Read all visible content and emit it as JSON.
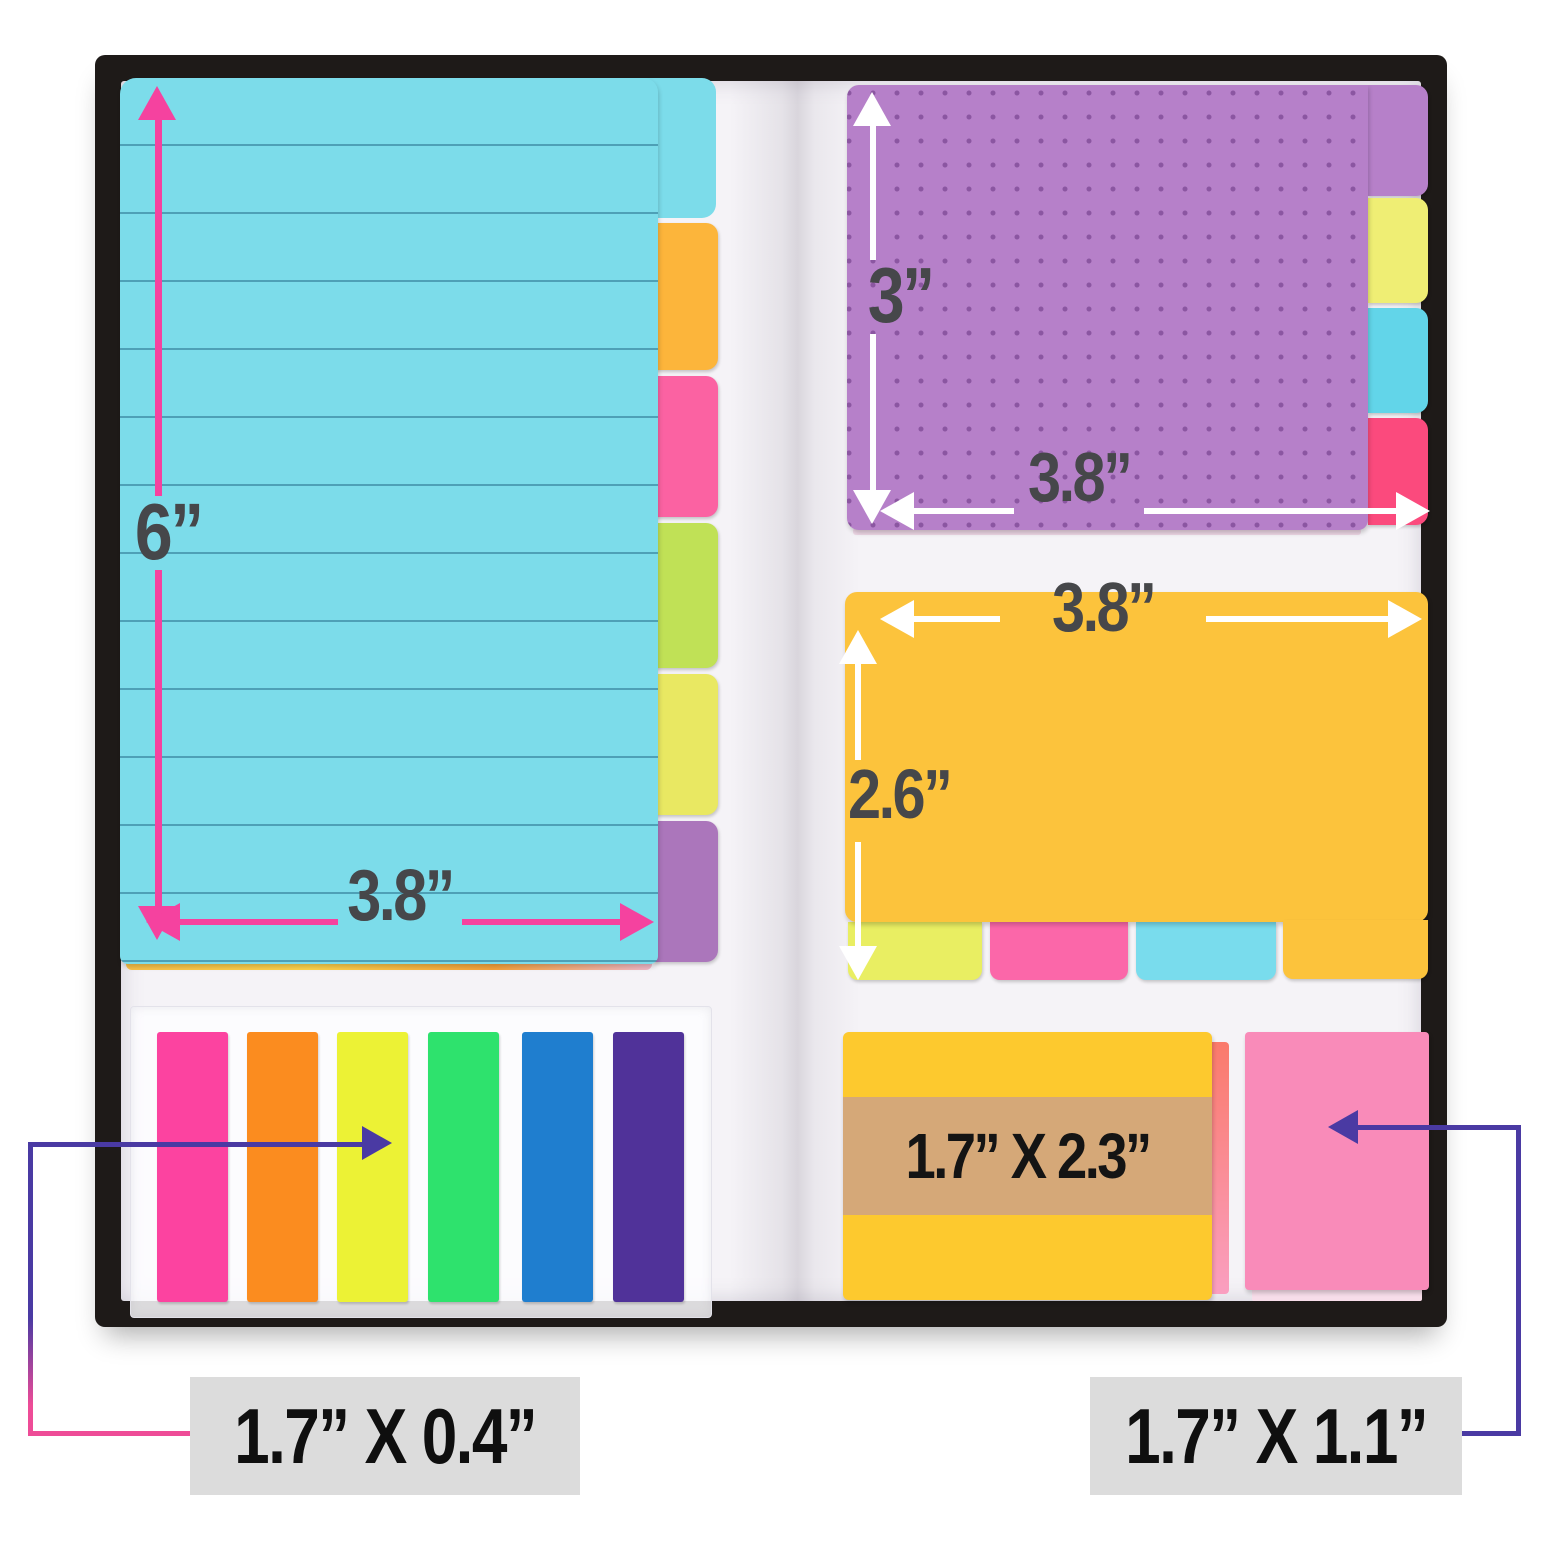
{
  "title": "Divider sticky notes set in black book cover with size annotations",
  "canvas": {
    "background": "#ffffff",
    "cover_color": "#1e1a18",
    "page_color": "#f5f3f7"
  },
  "dimension_text_color": "#46474a",
  "left_pad": {
    "description": "lined divider sticky note pad",
    "bg": "#7cdcea",
    "line_color": "#20647f",
    "height_label": "6”",
    "width_label": "3.8”",
    "arrow_color": "#f5429f",
    "tabs": [
      {
        "name": "cyan",
        "color": "#7cdcea"
      },
      {
        "name": "orange",
        "color": "#fcb53b"
      },
      {
        "name": "pink",
        "color": "#fb62a2"
      },
      {
        "name": "green",
        "color": "#c0e156"
      },
      {
        "name": "yellow",
        "color": "#e9e862"
      },
      {
        "name": "purple",
        "color": "#ab76bb"
      }
    ]
  },
  "purple_note": {
    "description": "dot-grid divider sticky note",
    "bg": "#b680c9",
    "dot_color": "#683480",
    "height_label": "3”",
    "width_label": "3.8”",
    "arrow_color": "#ffffff",
    "tabs": [
      {
        "name": "purple",
        "color": "#b680c9"
      },
      {
        "name": "yellow",
        "color": "#efee74"
      },
      {
        "name": "blue",
        "color": "#62d5e9"
      },
      {
        "name": "pink",
        "color": "#fb4a7d"
      }
    ]
  },
  "orange_note": {
    "description": "blank divider sticky note",
    "bg": "#fcc33c",
    "width_label": "3.8”",
    "height_label": "2.6”",
    "arrow_color": "#ffffff",
    "tabs": [
      {
        "name": "yellow-green",
        "color": "#e9ee62"
      },
      {
        "name": "pink",
        "color": "#fb67a9"
      },
      {
        "name": "blue",
        "color": "#79dced"
      },
      {
        "name": "orange",
        "color": "#fcc33c"
      }
    ]
  },
  "small_yellow_note": {
    "bg": "#fdc92e",
    "band_color": "#d5a878",
    "size_label": "1.7” X 2.3”"
  },
  "small_pink_note": {
    "bg": "#f98bb9",
    "size_label": "1.7” X 1.1”"
  },
  "page_flags": {
    "description": "six neon page marker flags on clear sheet",
    "size_label": "1.7” X 0.4”",
    "colors": [
      "#fc43a0",
      "#fb8c1f",
      "#ecf235",
      "#2ee26d",
      "#1f7ecf",
      "#503299"
    ]
  },
  "callouts": {
    "line_indigo": "#4a3aa3",
    "line_pink": "#ee4c97",
    "box_bg": "#dcdcdc",
    "text_color": "#0f0f0f"
  }
}
